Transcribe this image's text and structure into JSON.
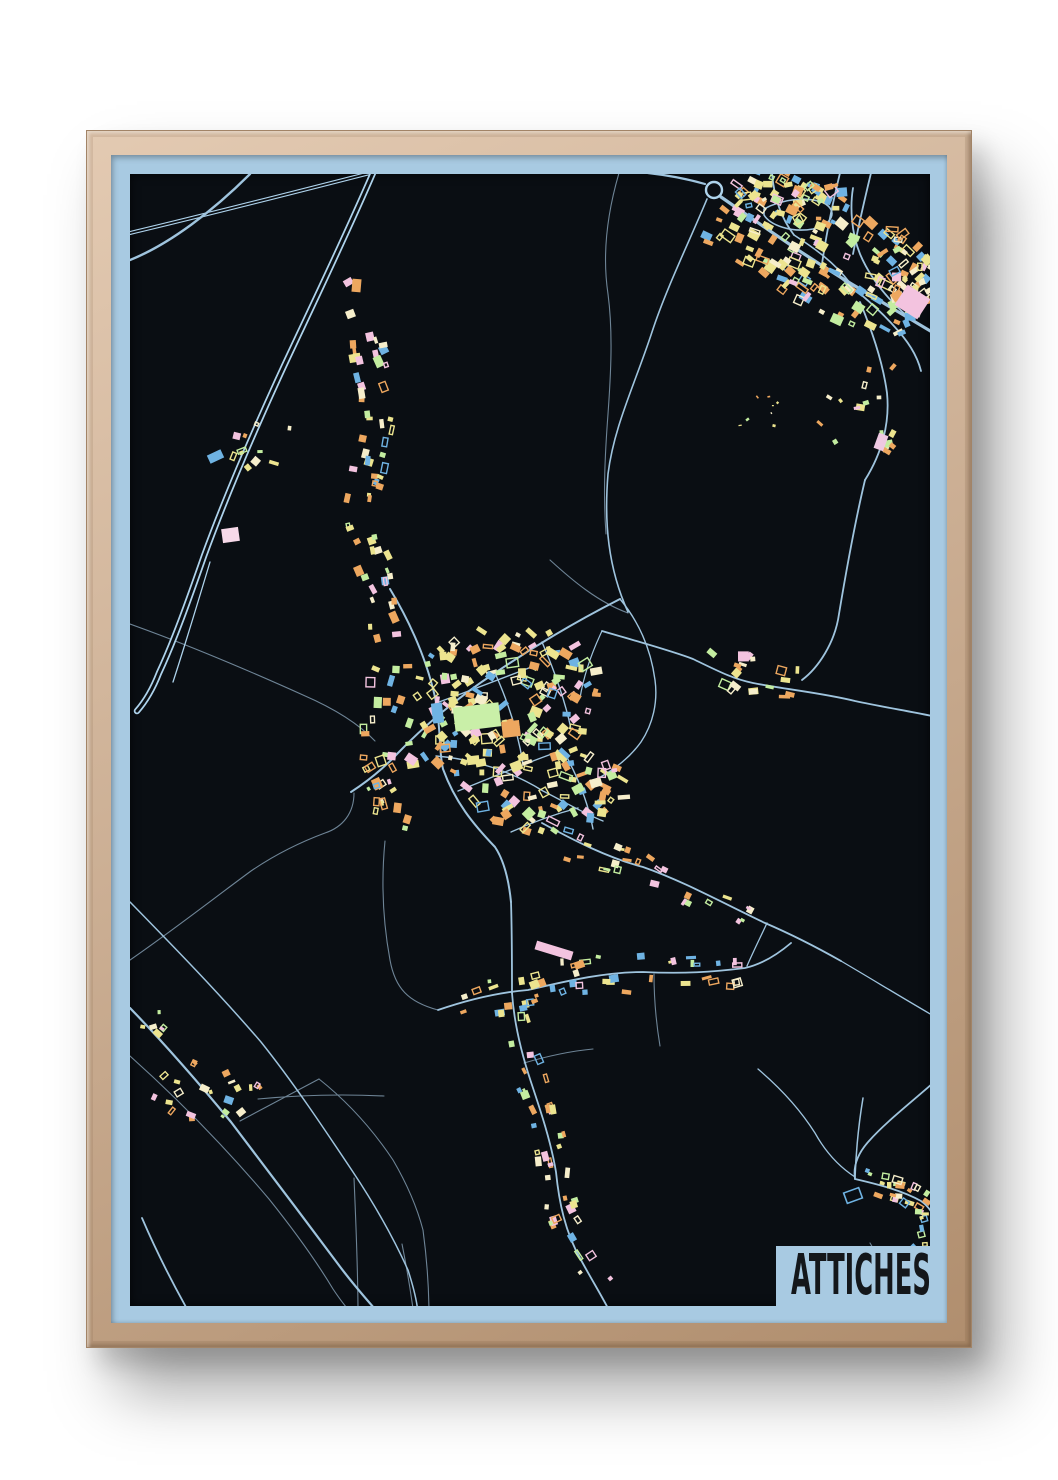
{
  "poster": {
    "title": "ATTICHES"
  },
  "colors": {
    "wall": "#ffffff",
    "frame_wood_light": "#e3cab2",
    "frame_wood_mid": "#cbae93",
    "frame_wood_dark": "#b08e6e",
    "mat_blue": "#a8cae2",
    "map_background": "#0a0e13",
    "road_major": "#9fc4de",
    "road_bright": "#aed3ec",
    "road_minor": "#6e8496",
    "title_ink": "#14171b"
  },
  "map": {
    "viewBox": "128 172 800 1132",
    "seed": 11,
    "building_palette": [
      "#ece48f",
      "#ece48f",
      "#eda75f",
      "#eda75f",
      "#6fb3e3",
      "#c3eda0",
      "#f3c3df",
      "#f6eecb"
    ],
    "roundabout": {
      "cx": 712,
      "cy": 188,
      "r": 8,
      "w": 2.4
    },
    "railway": {
      "d": "M128 231 C 208 212 290 191 372 170",
      "outer": 4,
      "inner": 1.8
    },
    "motorway": {
      "d": "M371 171 C 342 238 312 300 282 364 C 252 429 224 494 202 554 C 187 597 172 639 157 671 C 150 689 142 701 135 709",
      "outer": 6.5,
      "inner": 3,
      "ramp": "M208 560 C 196 600 184 640 171 680"
    },
    "roads_major": [
      {
        "d": "M128 258 C 168 242 212 208 248 172",
        "w": 2.4
      },
      {
        "d": "M703 182 C 682 176 664 173 646 171",
        "w": 2.2
      },
      {
        "d": "M719 195 C 758 222 800 252 848 281 C 880 300 908 317 930 330",
        "w": 3.2
      },
      {
        "d": "M705 197 C 688 238 664 287 650 330 C 633 382 612 424 606 472 C 602 520 606 566 626 610",
        "w": 1.6
      },
      {
        "d": "M770 171 C 772 196 779 216 792 233",
        "w": 1.8
      },
      {
        "d": "M838 171 C 830 204 824 234 820 262",
        "w": 1.8
      },
      {
        "d": "M869 171 C 862 200 856 226 851 252",
        "w": 1.8
      },
      {
        "d": "M905 314 C 888 299 869 278 858 252 C 849 230 848 204 851 186",
        "w": 1.8
      },
      {
        "d": "M762 207 C 780 197 806 194 822 201 C 836 209 831 222 811 227 C 789 231 768 223 762 213 Z",
        "w": 1.6
      },
      {
        "d": "M820 262 C 846 281 871 301 891 323 C 906 339 915 353 919 369",
        "w": 1.8
      },
      {
        "d": "M858 300 C 871 331 881 361 885 391 C 888 421 880 451 863 478",
        "w": 1.8
      },
      {
        "d": "M863 478 C 853 520 844 570 837 612 C 833 641 816 666 800 678",
        "w": 1.8
      },
      {
        "d": "M792 233 C 812 246 832 260 848 281",
        "w": 1.6
      },
      {
        "d": "M600 629 C 641 641 670 649 691 657 C 716 669 731 677 751 681 C 781 687 821 691 853 699 C 881 705 906 709 930 714",
        "w": 1.8
      },
      {
        "d": "M618 597 C 571 621 531 645 493 671 C 456 695 421 725 396 751 C 379 769 363 781 349 790",
        "w": 2
      },
      {
        "d": "M388 587 C 408 620 426 660 434 700 C 439 730 437 751 441 767 C 453 800 471 822 493 845 C 503 860 507 880 509 900",
        "w": 2
      },
      {
        "d": "M509 900 C 510 930 510 962 510 991",
        "w": 1.8
      },
      {
        "d": "M540 821 C 571 838 606 856 641 865 C 681 879 721 901 763 921 C 791 933 816 946 839 959",
        "w": 1.8
      },
      {
        "d": "M839 959 C 868 976 899 995 930 1013",
        "w": 1.3
      },
      {
        "d": "M436 1008 C 471 996 501 990 526 988 C 561 980 601 970 641 970 C 681 972 711 970 743 966 C 761 962 776 952 789 941",
        "w": 1.8
      },
      {
        "d": "M510 991 C 512 1020 519 1050 529 1080 C 539 1110 549 1140 554 1170 C 557 1200 563 1230 579 1258 C 591 1280 601 1296 609 1312",
        "w": 1.8
      },
      {
        "d": "M128 1006 C 161 1040 196 1080 229 1120 C 263 1165 301 1215 336 1262 C 353 1285 367 1300 379 1314",
        "w": 2.2
      },
      {
        "d": "M140 1216 C 155 1251 172 1284 189 1314",
        "w": 1.8
      },
      {
        "d": "M128 900 C 171 944 216 990 259 1040 C 291 1080 321 1125 351 1170 C 371 1200 391 1235 406 1268 C 413 1290 416 1304 416 1314",
        "w": 1.5
      },
      {
        "d": "M930 1082 C 906 1103 883 1121 867 1139 C 856 1151 851 1164 853 1177",
        "w": 1.8
      },
      {
        "d": "M853 1177 C 879 1183 901 1189 919 1199 C 929 1206 935 1218 937 1232",
        "w": 1.8
      },
      {
        "d": "M861 1096 C 857 1120 854 1148 853 1177",
        "w": 1.5
      },
      {
        "d": "M853 1175 C 836 1164 823 1149 813 1131 C 796 1104 776 1084 756 1067",
        "w": 1.3
      },
      {
        "d": "M937 1232 C 928 1252 916 1272 903 1292 C 897 1300 892 1308 889 1314",
        "w": 1.5
      },
      {
        "d": "M745 964 C 752 948 759 934 765 921",
        "w": 1.3
      },
      {
        "d": "M437 700 C 470 688 501 676 532 664",
        "w": 1.4
      },
      {
        "d": "M456 789 C 491 775 526 760 561 748",
        "w": 1.4
      },
      {
        "d": "M493 671 C 506 700 516 730 521 762",
        "w": 1.4
      },
      {
        "d": "M561 748 C 576 775 586 800 591 827",
        "w": 1.4
      },
      {
        "d": "M540 640 C 552 668 563 698 569 727",
        "w": 1.4
      },
      {
        "d": "M618 597 C 637 620 649 648 653 678 C 656 700 651 722 639 740 C 626 758 609 770 591 779",
        "w": 1.4
      },
      {
        "d": "M434 754 C 471 757 509 769 541 789 C 561 799 581 811 601 819",
        "w": 1.4
      },
      {
        "d": "M509 830 C 531 820 553 812 576 806",
        "w": 1.4
      },
      {
        "d": "M600 629 C 590 650 582 672 578 696",
        "w": 1.2
      }
    ],
    "roads_minor": [
      {
        "d": "M617 171 C 605 212 600 252 606 292 C 611 330 609 370 606 412 C 603 452 601 492 604 532",
        "w": 1.1
      },
      {
        "d": "M128 622 C 181 641 241 666 301 693 C 331 706 356 721 373 739",
        "w": 1.1
      },
      {
        "d": "M128 958 C 170 929 211 897 249 869 C 271 854 296 841 323 831 C 341 825 352 811 352 791",
        "w": 1.1
      },
      {
        "d": "M128 1054 C 176 1097 223 1145 267 1197 C 291 1227 313 1257 331 1287 C 339 1299 347 1309 353 1315",
        "w": 1.1
      },
      {
        "d": "M238 1119 L 317 1077",
        "w": 1.1
      },
      {
        "d": "M317 1077 C 346 1100 371 1128 391 1158 C 405 1182 415 1205 421 1228",
        "w": 1.1
      },
      {
        "d": "M421 1228 C 425 1258 427 1287 427 1314",
        "w": 1.1
      },
      {
        "d": "M256 1097 C 298 1093 340 1092 382 1094",
        "w": 1.1
      },
      {
        "d": "M352 1176 C 354 1222 356 1268 356 1312",
        "w": 1.1
      },
      {
        "d": "M400 1242 C 405 1267 409 1291 412 1314",
        "w": 1.1
      },
      {
        "d": "M548 558 C 571 579 596 600 626 611",
        "w": 1.1
      },
      {
        "d": "M522 1061 C 546 1054 569 1049 591 1047",
        "w": 1.1
      },
      {
        "d": "M868 1241 C 880 1261 892 1282 902 1303",
        "w": 1.1
      },
      {
        "d": "M383 839 C 379 880 381 920 388 958 C 393 986 406 1000 436 1008",
        "w": 1.1
      },
      {
        "d": "M652 972 C 652 996 654 1020 658 1044",
        "w": 1.1
      }
    ],
    "clusters": [
      {
        "type": "strip",
        "pts": [
          [
            728,
            192
          ],
          [
            788,
            229
          ],
          [
            849,
            266
          ],
          [
            906,
            306
          ]
        ],
        "w": 52,
        "n": 150,
        "s": 6.5
      },
      {
        "type": "blob",
        "cx": 898,
        "cy": 282,
        "rx": 30,
        "ry": 58,
        "n": 45,
        "s": 6.5
      },
      {
        "type": "blob",
        "cx": 790,
        "cy": 198,
        "rx": 55,
        "ry": 26,
        "n": 30,
        "s": 6
      },
      {
        "type": "strip",
        "pts": [
          [
            338,
            272
          ],
          [
            360,
            330
          ],
          [
            376,
            390
          ],
          [
            373,
            450
          ],
          [
            358,
            520
          ],
          [
            378,
            590
          ],
          [
            391,
            650
          ],
          [
            379,
            710
          ],
          [
            375,
            760
          ],
          [
            391,
            800
          ],
          [
            386,
            840
          ]
        ],
        "w": 15,
        "n": 95,
        "s": 6
      },
      {
        "type": "blob",
        "cx": 505,
        "cy": 682,
        "rx": 92,
        "ry": 58,
        "n": 120,
        "s": 6.5
      },
      {
        "type": "blob",
        "cx": 545,
        "cy": 778,
        "rx": 82,
        "ry": 56,
        "n": 95,
        "s": 6.5
      },
      {
        "type": "blob",
        "cx": 440,
        "cy": 735,
        "rx": 40,
        "ry": 40,
        "n": 35,
        "s": 6.5
      },
      {
        "type": "strip",
        "pts": [
          [
            560,
            843
          ],
          [
            640,
            866
          ],
          [
            700,
            893
          ],
          [
            758,
            920
          ]
        ],
        "w": 11,
        "n": 26,
        "s": 5
      },
      {
        "type": "strip",
        "pts": [
          [
            700,
            656
          ],
          [
            742,
            679
          ],
          [
            796,
            683
          ]
        ],
        "w": 12,
        "n": 16,
        "s": 6
      },
      {
        "type": "blob",
        "cx": 868,
        "cy": 408,
        "rx": 55,
        "ry": 48,
        "n": 12,
        "s": 5
      },
      {
        "type": "strip",
        "pts": [
          [
            452,
            1002
          ],
          [
            524,
            988
          ],
          [
            592,
            972
          ],
          [
            660,
            972
          ],
          [
            736,
            966
          ]
        ],
        "w": 16,
        "n": 48,
        "s": 5.5
      },
      {
        "type": "strip",
        "pts": [
          [
            512,
            1010
          ],
          [
            524,
            1062
          ],
          [
            541,
            1112
          ],
          [
            553,
            1162
          ],
          [
            558,
            1205
          ],
          [
            584,
            1255
          ],
          [
            604,
            1292
          ]
        ],
        "w": 13,
        "n": 42,
        "s": 5.5
      },
      {
        "type": "blob",
        "cx": 205,
        "cy": 1090,
        "rx": 55,
        "ry": 32,
        "n": 22,
        "s": 5
      },
      {
        "type": "blob",
        "cx": 150,
        "cy": 1022,
        "rx": 12,
        "ry": 20,
        "n": 6,
        "s": 5
      },
      {
        "type": "strip",
        "pts": [
          [
            856,
            1182
          ],
          [
            900,
            1190
          ],
          [
            928,
            1206
          ],
          [
            934,
            1242
          ]
        ],
        "w": 12,
        "n": 40,
        "s": 5
      },
      {
        "type": "blob",
        "cx": 916,
        "cy": 1272,
        "rx": 22,
        "ry": 26,
        "n": 18,
        "s": 5
      },
      {
        "type": "blob",
        "cx": 258,
        "cy": 442,
        "rx": 38,
        "ry": 26,
        "n": 11,
        "s": 5.5
      },
      {
        "type": "blob",
        "cx": 760,
        "cy": 410,
        "rx": 28,
        "ry": 22,
        "n": 8,
        "s": 2.2
      },
      {
        "type": "blob",
        "cx": 744,
        "cy": 654,
        "rx": 8,
        "ry": 6,
        "n": 3,
        "s": 7
      },
      {
        "type": "blob",
        "cx": 882,
        "cy": 440,
        "rx": 14,
        "ry": 12,
        "n": 5,
        "s": 5
      }
    ],
    "special_buildings": [
      {
        "x": 452,
        "y": 703,
        "w": 46,
        "h": 24,
        "f": "#c9efa8",
        "r": -7
      },
      {
        "x": 500,
        "y": 719,
        "w": 18,
        "h": 16,
        "f": "#eda75f",
        "r": -7
      },
      {
        "x": 430,
        "y": 701,
        "w": 11,
        "h": 20,
        "f": "#6fb3e3",
        "r": -7
      },
      {
        "x": 533,
        "y": 944,
        "w": 38,
        "h": 9,
        "f": "#f3c3df",
        "r": 17
      },
      {
        "x": 897,
        "y": 288,
        "w": 27,
        "h": 24,
        "f": "#f3c3df",
        "r": 33
      },
      {
        "x": 206,
        "y": 450,
        "w": 15,
        "h": 9,
        "f": "#6fb3e3",
        "r": -25
      },
      {
        "x": 220,
        "y": 526,
        "w": 17,
        "h": 14,
        "f": "#f7d9e9",
        "r": -8
      },
      {
        "x": 843,
        "y": 1188,
        "w": 16,
        "h": 11,
        "f": "none",
        "st": "#6fb3e3",
        "r": -20
      },
      {
        "x": 874,
        "y": 432,
        "w": 10,
        "h": 16,
        "f": "#efc9e2",
        "r": 20
      },
      {
        "x": 350,
        "y": 277,
        "w": 9,
        "h": 13,
        "f": "#eda75f",
        "r": 5
      }
    ]
  }
}
